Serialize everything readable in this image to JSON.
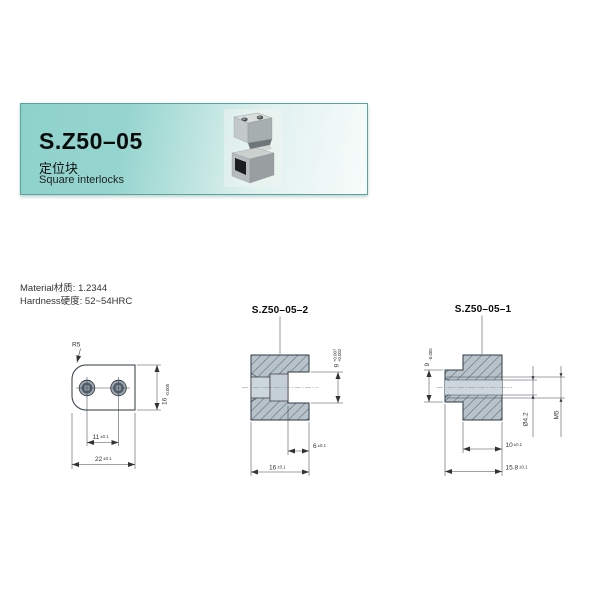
{
  "header": {
    "title": "S.Z50–05",
    "subtitle_cn": "定位块",
    "subtitle_en": "Square interlocks"
  },
  "specs": {
    "material": "Material材质: 1.2344",
    "hardness": "Hardness硬度: 52~54HRC"
  },
  "colors": {
    "banner_teal": "#8ed1cb",
    "banner_light": "#f8fcfb",
    "metal_light": "#dde4e9",
    "metal_dark": "#a8b8c2",
    "hatch_bg": "#b7c2cb",
    "hatch_line": "#5a6670",
    "cavity_gray": "#ccd6dd",
    "outline": "#2f3a42"
  },
  "drawings": {
    "top_view": {
      "radius": "R5",
      "height": "16",
      "height_tol": "-0.005",
      "spacing": "11",
      "spacing_tol": "±0.1",
      "width": "22",
      "width_tol": "±0.1"
    },
    "section2": {
      "title": "S.Z50–05–2",
      "slot": "9",
      "slot_tol_up": "+0.007",
      "slot_tol_low": "+0.002",
      "depth": "6",
      "depth_tol": "±0.1",
      "width": "16",
      "width_tol": "±0.1"
    },
    "section1": {
      "title": "S.Z50–05–1",
      "tongue": "9",
      "tongue_tol": "-0.005",
      "hole": "Ø4.2",
      "thread": "M5",
      "body": "10",
      "body_tol": "±0.1",
      "total": "15.8",
      "total_tol": "±0.1"
    }
  }
}
